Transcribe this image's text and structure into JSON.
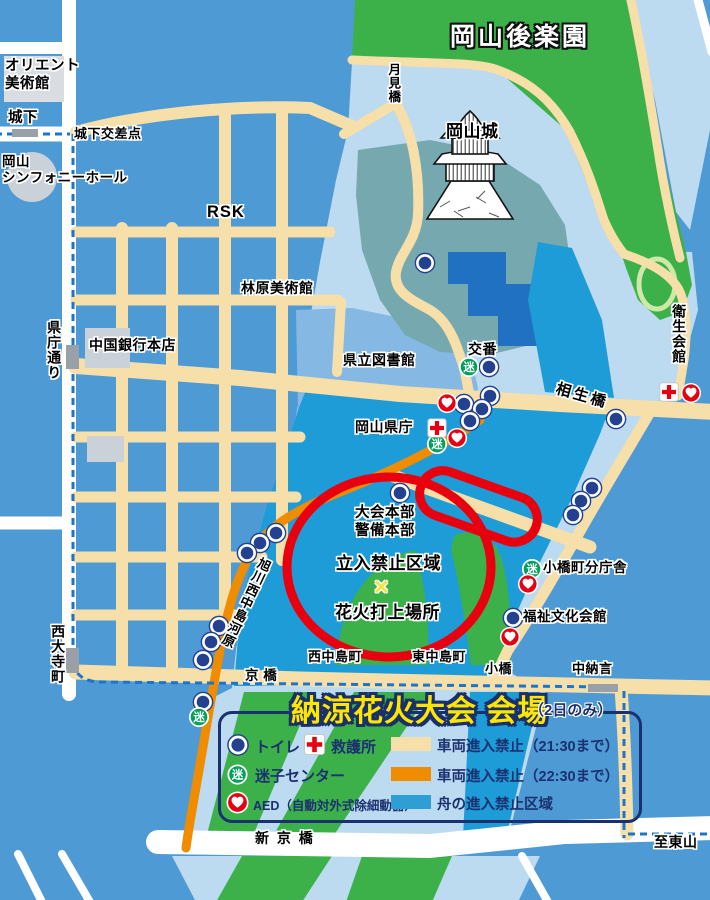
{
  "map_title": "納涼花火大会 会場",
  "labels": {
    "korakuen": "岡山後楽園",
    "tsukimibashi": "月見橋",
    "okayama_castle": "岡山城",
    "orient_museum": "オリエント\n美術館",
    "shiroshita": "城下",
    "shiroshita_crossing": "城下交差点",
    "symphony_hall": "岡山\nシンフォニーホール",
    "rsk": "RSK",
    "hayashibara_museum": "林原美術館",
    "chugoku_bank": "中国銀行本店",
    "kencho_dori": "県庁通り",
    "pref_library": "県立図書館",
    "koban": "交番",
    "aioibashi": "相生橋",
    "eisei_kaikan": "衛生会館",
    "pref_office": "岡山県庁",
    "hq": "大会本部\n警備本部",
    "no_entry_zone": "立入禁止区域",
    "launch_x": "×",
    "launch_site": "花火打上場所",
    "asahikawa_kawara": "旭川西中島河原",
    "nishinakajima": "西中島町",
    "higashinakajima": "東中島町",
    "kobashi": "小橋",
    "chunagon": "中納言",
    "kyobashi": "京 橋",
    "saidaiji_cho": "西大寺町",
    "kobashicho_branch": "小橋町分庁舎",
    "fukushi_kaikan": "福祉文化会館",
    "shinkyobashi": "新 京 橋",
    "to_higashiyama": "至東山"
  },
  "legend": {
    "title": "納涼花火大会 会場",
    "note": "（2日のみ）",
    "items": {
      "toilet": "トイレ",
      "first_aid": "救護所",
      "lost_child": "迷子センター",
      "aed": "AED（自動対外式除細動器）",
      "no_vehicles_2130": "車両進入禁止（21:30まで）",
      "no_vehicles_2230": "車両進入禁止（22:30まで）",
      "no_boats": "舟の進入禁止区域"
    }
  },
  "icons": {
    "lost_glyph": "迷",
    "toilet": "toilet-icon",
    "first_aid": "first-aid-cross-icon",
    "lost_child": "lost-child-icon",
    "aed": "aed-heart-icon",
    "castle": "castle-icon"
  },
  "colors": {
    "city_block": "#4E9AD5",
    "river_light": "#BCDAF0",
    "river_mid_zone": "#86B8E4",
    "boat_prohibited_blue": "#1E9CD7",
    "park_green": "#3CB14A",
    "castle_hill_teal": "#76A8B0",
    "building_dark_blue": "#2171C2",
    "road_open_white": "#FFFFFF",
    "road_closed_2130_cream": "#F6DFA8",
    "road_closed_2230_orange": "#F08C00",
    "tram_line_blue": "#1D74CC",
    "restricted_outline_red": "#E8000F",
    "legend_navy": "#1B3070",
    "title_yellow": "#FFE600"
  }
}
